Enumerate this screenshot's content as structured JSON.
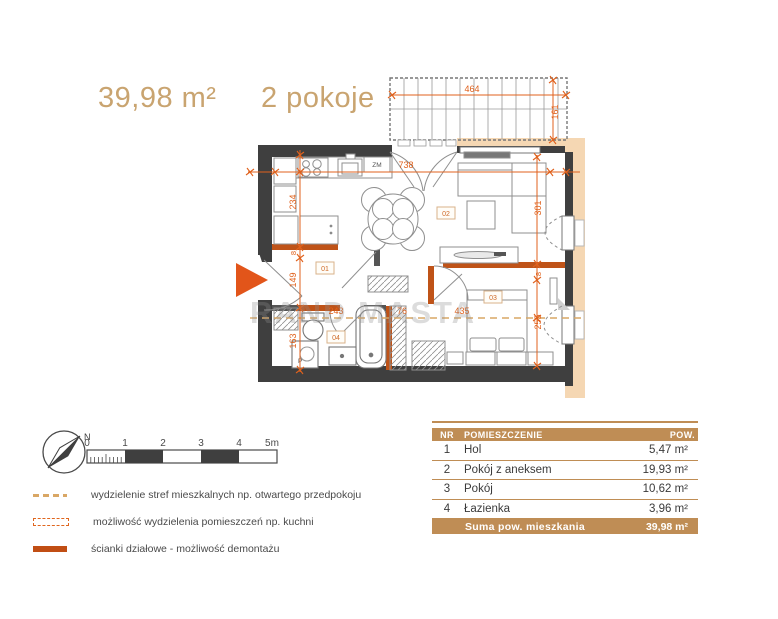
{
  "header": {
    "area": "39,98 m²",
    "rooms": "2 pokoje"
  },
  "watermark": "RAND MASTA",
  "plan": {
    "room_labels": {
      "hall": "01",
      "living": "02",
      "bedroom": "03",
      "bathroom": "04"
    },
    "appliances": {
      "dishwasher": "ZM",
      "washer": "P"
    },
    "dims": {
      "balcony_width": "464",
      "balcony_depth": "161",
      "interior_width": "738",
      "kitchen_side": "234",
      "wall_a": "8",
      "hall_height": "149",
      "bathroom_height": "163",
      "zone_hall": "243",
      "zone_bath": "76",
      "zone_bedroom": "435",
      "living_side": "301",
      "wall_b": "8",
      "bedroom_side": "255"
    },
    "colors": {
      "dimension": "#e0611c",
      "wall": "#3f3f3f",
      "exterior_fill": "#f5d7b3",
      "partition": "#bf5318"
    }
  },
  "compass": {
    "north": "N"
  },
  "scalebar": {
    "ticks": [
      "0",
      "1",
      "2",
      "3",
      "4",
      "5m"
    ]
  },
  "legend": {
    "items": [
      {
        "label": "wydzielenie stref mieszkalnych np. otwartego przedpokoju"
      },
      {
        "label": "możliwość wydzielenia pomieszczeń np. kuchni"
      },
      {
        "label": "ścianki działowe -  możliwość demontażu"
      }
    ]
  },
  "table": {
    "headers": [
      "NR",
      "POMIESZCZENIE",
      "POW."
    ],
    "rows": [
      [
        "1",
        "Hol",
        "5,47 m²"
      ],
      [
        "2",
        "Pokój z aneksem",
        "19,93 m²"
      ],
      [
        "3",
        "Pokój",
        "10,62 m²"
      ],
      [
        "4",
        "Łazienka",
        "3,96 m²"
      ]
    ],
    "footer": {
      "label": "Suma pow. mieszkania",
      "value": "39,98 m²"
    }
  }
}
